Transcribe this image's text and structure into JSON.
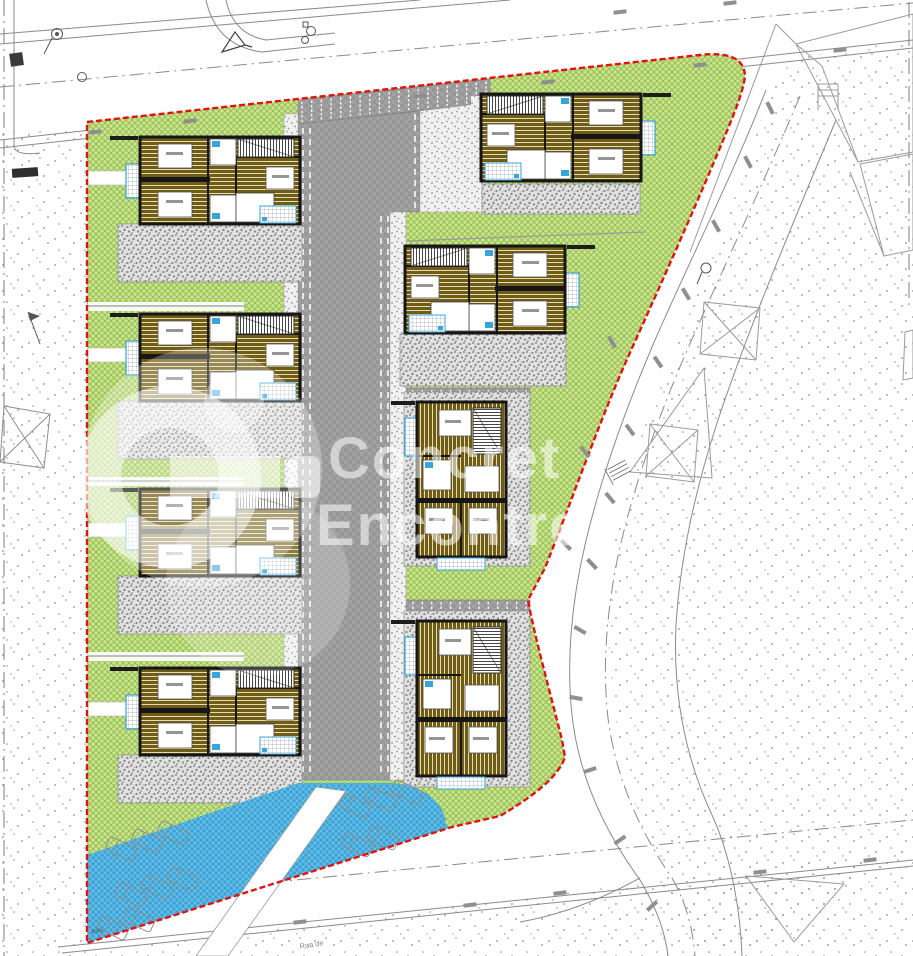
{
  "watermark": {
    "line1": "Concret",
    "line2": "Encontre.",
    "logo": "ring-with-bar-and-dot"
  },
  "labels": {
    "rsu": "RSU",
    "street_name": "Rua de"
  },
  "colors": {
    "green_bg": "#cde394",
    "green_line": "#94c14e",
    "road": "#a1a1a1",
    "road_check": "#979797",
    "gravel_bg": "#e2e2e2",
    "gravel_dot": "#878787",
    "stipple_dot": "#8f8f8f",
    "sidewalk_bg": "#f0f0f0",
    "blue": "#39a4d8",
    "blue_line": "#79c4e6",
    "floor": "#6e5c17",
    "floor_line": "#e7ddb0",
    "wall": "#1a1a1a",
    "red_boundary": "#e01212",
    "outline_gray": "#8f8f8f",
    "white": "#ffffff"
  },
  "site": {
    "boundary_style": "red-dashed",
    "lawn_hatch": "green-cross-hatch",
    "blue_area": "vehicle-ramp-parking",
    "houses": [
      {
        "id": "house-1",
        "type": "A",
        "x": 140,
        "y": 137,
        "mirror": false
      },
      {
        "id": "house-2",
        "type": "A",
        "x": 140,
        "y": 314,
        "mirror": false
      },
      {
        "id": "house-3",
        "type": "A",
        "x": 140,
        "y": 489,
        "mirror": false
      },
      {
        "id": "house-4",
        "type": "A",
        "x": 140,
        "y": 668,
        "mirror": false
      },
      {
        "id": "house-5",
        "type": "A",
        "x": 481,
        "y": 94,
        "mirror": true
      },
      {
        "id": "house-6",
        "type": "A",
        "x": 405,
        "y": 246,
        "mirror": true
      },
      {
        "id": "house-7",
        "type": "B",
        "x": 417,
        "y": 402,
        "mirror": false
      },
      {
        "id": "house-8",
        "type": "B",
        "x": 417,
        "y": 621,
        "mirror": false
      }
    ],
    "parking": {
      "top_stall_count": 20,
      "stub_stall_count": 15,
      "stub_rows": 2,
      "cars_visible": 13
    }
  }
}
